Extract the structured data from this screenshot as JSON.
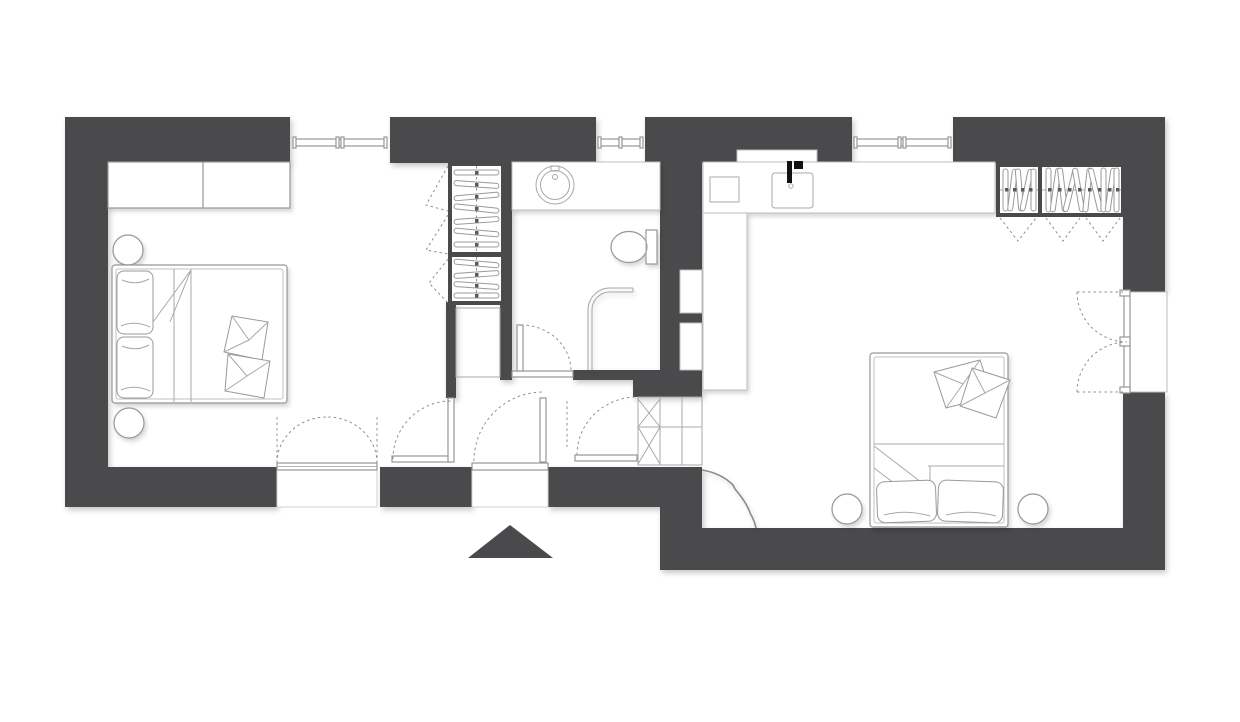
{
  "drawing": {
    "kind": "apartment floor plan",
    "rooms": [
      {
        "id": "bedroom-left",
        "fixtures": [
          "double-bed",
          "bed-pillows",
          "decor-cushions",
          "round-nightstand",
          "round-nightstand",
          "low-dresser",
          "window",
          "french-balcony-door"
        ]
      },
      {
        "id": "hall",
        "fixtures": [
          "shelf-wardrobe",
          "folding-wardrobe-doors",
          "storage-niche",
          "interior-door",
          "entrance-door",
          "winder-stairs",
          "stair-door"
        ]
      },
      {
        "id": "bathroom",
        "fixtures": [
          "washbasin-counter",
          "round-basin",
          "faucet",
          "toilet",
          "walk-in-shower-screen",
          "window",
          "bathroom-door"
        ]
      },
      {
        "id": "bedroom-right",
        "fixtures": [
          "kitchen-counter",
          "kitchen-sink",
          "kitchen-faucet",
          "hob",
          "wall-recess",
          "hanger-wardrobe",
          "folding-wardrobe-doors",
          "double-bed",
          "bed-pillows",
          "decor-cushions",
          "round-nightstand",
          "round-nightstand",
          "wall-niche",
          "wall-niche",
          "french-balcony-door",
          "window",
          "curtain-arc"
        ]
      }
    ],
    "entrance_marker": "arrow-up-triangle"
  },
  "colors": {
    "wall": "#4a4a4c",
    "background": "#ffffff",
    "fixture_line": "#979797",
    "light_line": "#c2c2c2",
    "dash_line": "#8f8f8f",
    "faucet_black": "#111111"
  }
}
